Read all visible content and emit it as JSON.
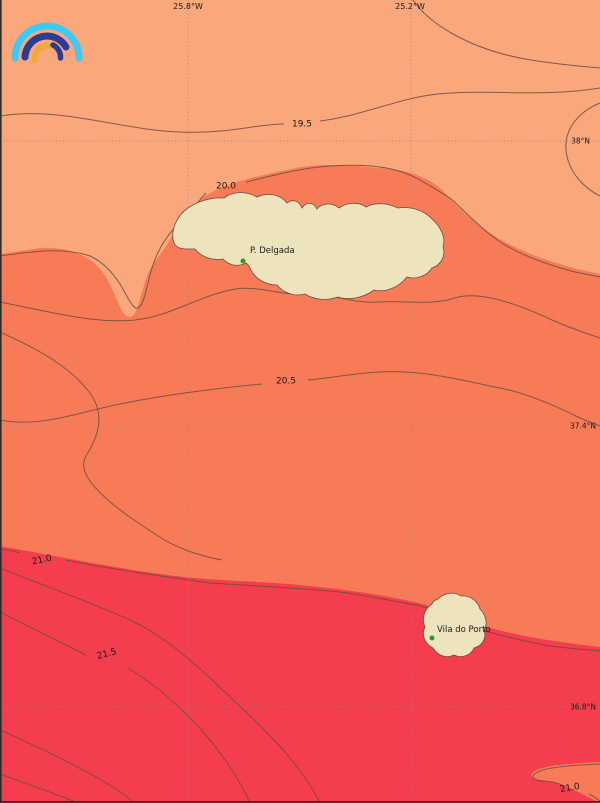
{
  "map": {
    "description": "Sea surface temperature isotherm map of the Azores (Sao Miguel and Santa Maria)",
    "axis": {
      "top_labels": [
        {
          "text": "25.8°W"
        },
        {
          "text": "25.2°W"
        }
      ],
      "right_labels": [
        {
          "text": "38°N"
        },
        {
          "text": "37.4°N"
        },
        {
          "text": "36.8°N"
        }
      ]
    },
    "isotherm_labels": [
      {
        "value": "19.5"
      },
      {
        "value": "20.0"
      },
      {
        "value": "20.5"
      },
      {
        "value": "21.0"
      },
      {
        "value": "21.5"
      },
      {
        "value": "21.0"
      }
    ],
    "places": [
      {
        "name": "P. Delgada"
      },
      {
        "name": "Vila do Porto"
      }
    ],
    "colors": {
      "band_cool": "#FAA77B",
      "band_mid": "#F87B58",
      "band_warm": "#F43D4D",
      "land": "#EDE4BD",
      "contour": "#6F4B41",
      "grid": "#8C8C8C",
      "text": "#1A1A1A",
      "place_dot": "#23A123",
      "logo_cyan": "#41C8F5",
      "logo_navy": "#2B3C92",
      "logo_yellow": "#F2A93B"
    },
    "logo": {
      "name": "rainbow-arcs-logo"
    }
  }
}
